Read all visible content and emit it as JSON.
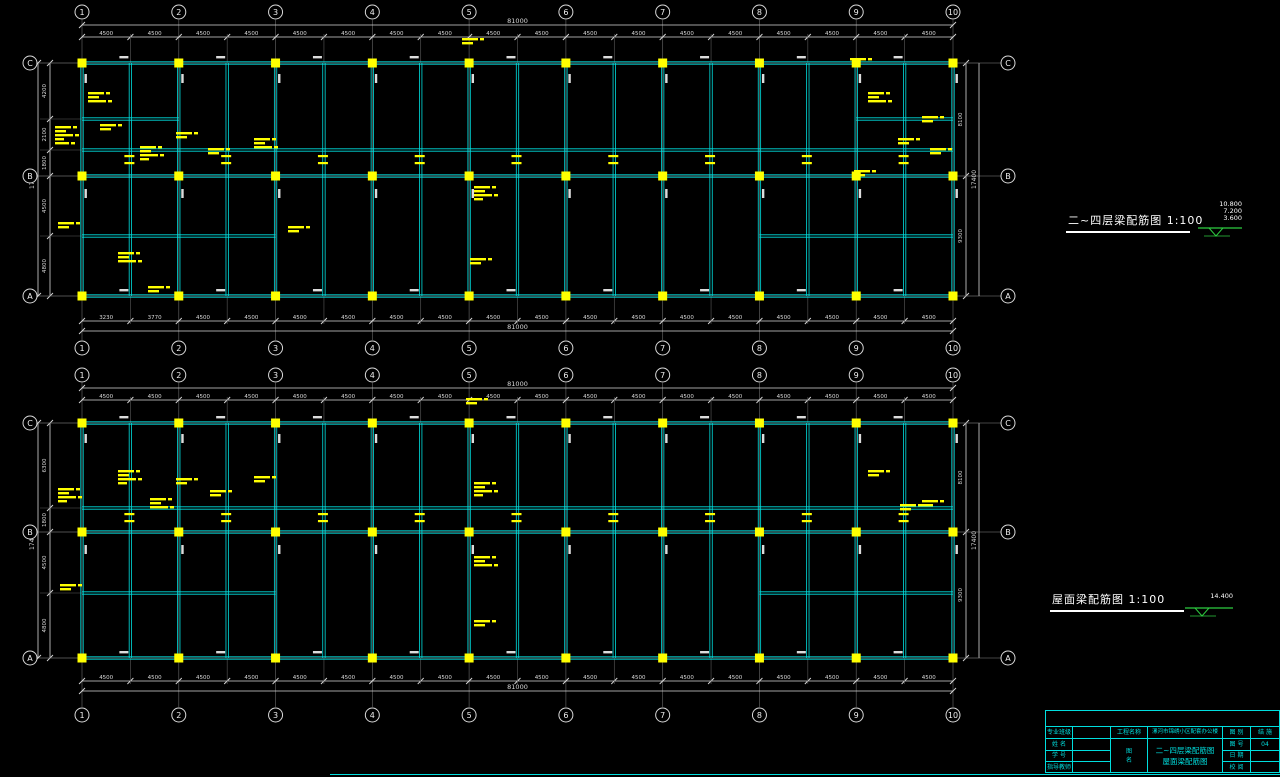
{
  "colors": {
    "beam": "#00e0e0",
    "grid": "#5c5c5c",
    "dimension": "#d9d9d9",
    "column": "#ffff00",
    "annotation": "#ffff00",
    "title_text": "#ffffff",
    "elevation": "#2ecc40",
    "titleblock": "#00dede"
  },
  "plans": [
    {
      "name": "floors-2-4-beam-plan",
      "title": "二~四层梁配筋图 1:100",
      "grid_numbers": [
        "1",
        "2",
        "3",
        "4",
        "5",
        "6",
        "7",
        "8",
        "9",
        "10"
      ],
      "row_letters": [
        "C",
        "B",
        "A"
      ],
      "top_overall_dim": "81000",
      "top_bay_dims": [
        "4500",
        "4500",
        "4500",
        "4500",
        "4500",
        "4500",
        "4500",
        "4500",
        "4500",
        "4500",
        "4500",
        "4500",
        "4500",
        "4500",
        "4500",
        "4500",
        "4500",
        "4500"
      ],
      "bottom_bay_dims": [
        "3230",
        "3770",
        "4500",
        "4500",
        "4500",
        "4500",
        "4500",
        "4500",
        "4500",
        "4500",
        "4500",
        "4500",
        "4500",
        "4500",
        "4500",
        "4500",
        "4500",
        "4500"
      ],
      "bottom_overall_dim": "81000",
      "left_dims": [
        "4200",
        "2100",
        "1800",
        "4500",
        "4800"
      ],
      "left_overall_dim": "17400",
      "right_dims": [
        "8100",
        "9300"
      ],
      "right_overall_dim": "17400",
      "annotation_clusters": [
        [
          462,
          38,
          2
        ],
        [
          88,
          92,
          3
        ],
        [
          55,
          126,
          5
        ],
        [
          100,
          124,
          2
        ],
        [
          140,
          146,
          4
        ],
        [
          118,
          252,
          3
        ],
        [
          176,
          132,
          2
        ],
        [
          208,
          148,
          2
        ],
        [
          254,
          138,
          3
        ],
        [
          288,
          226,
          2
        ],
        [
          474,
          186,
          4
        ],
        [
          470,
          258,
          2
        ],
        [
          850,
          58,
          1
        ],
        [
          868,
          92,
          3
        ],
        [
          898,
          138,
          2
        ],
        [
          922,
          116,
          2
        ],
        [
          930,
          148,
          2
        ],
        [
          58,
          222,
          2
        ],
        [
          148,
          286,
          2
        ],
        [
          854,
          170,
          2
        ]
      ]
    },
    {
      "name": "roof-beam-plan",
      "title": "屋面梁配筋图 1:100",
      "grid_numbers": [
        "1",
        "2",
        "3",
        "4",
        "5",
        "6",
        "7",
        "8",
        "9",
        "10"
      ],
      "row_letters": [
        "C",
        "B",
        "A"
      ],
      "top_overall_dim": "81000",
      "top_bay_dims": [
        "4500",
        "4500",
        "4500",
        "4500",
        "4500",
        "4500",
        "4500",
        "4500",
        "4500",
        "4500",
        "4500",
        "4500",
        "4500",
        "4500",
        "4500",
        "4500",
        "4500",
        "4500"
      ],
      "bottom_bay_dims": [
        "4500",
        "4500",
        "4500",
        "4500",
        "4500",
        "4500",
        "4500",
        "4500",
        "4500",
        "4500",
        "4500",
        "4500",
        "4500",
        "4500",
        "4500",
        "4500",
        "4500",
        "4500"
      ],
      "bottom_overall_dim": "81000",
      "left_dims": [
        "6300",
        "1800",
        "4500",
        "4800"
      ],
      "left_overall_dim": "17400",
      "right_dims": [
        "8100",
        "9300"
      ],
      "right_overall_dim": "17400",
      "annotation_clusters": [
        [
          466,
          398,
          2
        ],
        [
          58,
          488,
          4
        ],
        [
          118,
          470,
          4
        ],
        [
          150,
          498,
          3
        ],
        [
          474,
          482,
          4
        ],
        [
          474,
          556,
          3
        ],
        [
          474,
          620,
          2
        ],
        [
          900,
          504,
          2
        ],
        [
          60,
          584,
          2
        ],
        [
          176,
          478,
          2
        ],
        [
          210,
          490,
          2
        ],
        [
          254,
          476,
          2
        ],
        [
          868,
          470,
          2
        ],
        [
          922,
          500,
          2
        ]
      ]
    }
  ],
  "elevation_markers": [
    {
      "values": [
        "10.800",
        "7.200",
        "3.600"
      ]
    },
    {
      "values": [
        "14.400"
      ]
    }
  ],
  "title_block": {
    "left_rows": [
      "专业班级",
      "姓 名",
      "学 号",
      "指导教师"
    ],
    "project_label": "工程名称",
    "project_name": "漯河市锦绣小区配套办公楼",
    "sheet_label_top": "图",
    "sheet_label_bottom": "名",
    "sheet_name_line1": "二~四层梁配筋图",
    "sheet_name_line2": "屋面梁配筋图",
    "right_rows": [
      {
        "label": "图 别",
        "value": "结 施"
      },
      {
        "label": "图 号",
        "value": "04"
      },
      {
        "label": "日 期",
        "value": ""
      },
      {
        "label": "校 阅",
        "value": ""
      }
    ]
  }
}
